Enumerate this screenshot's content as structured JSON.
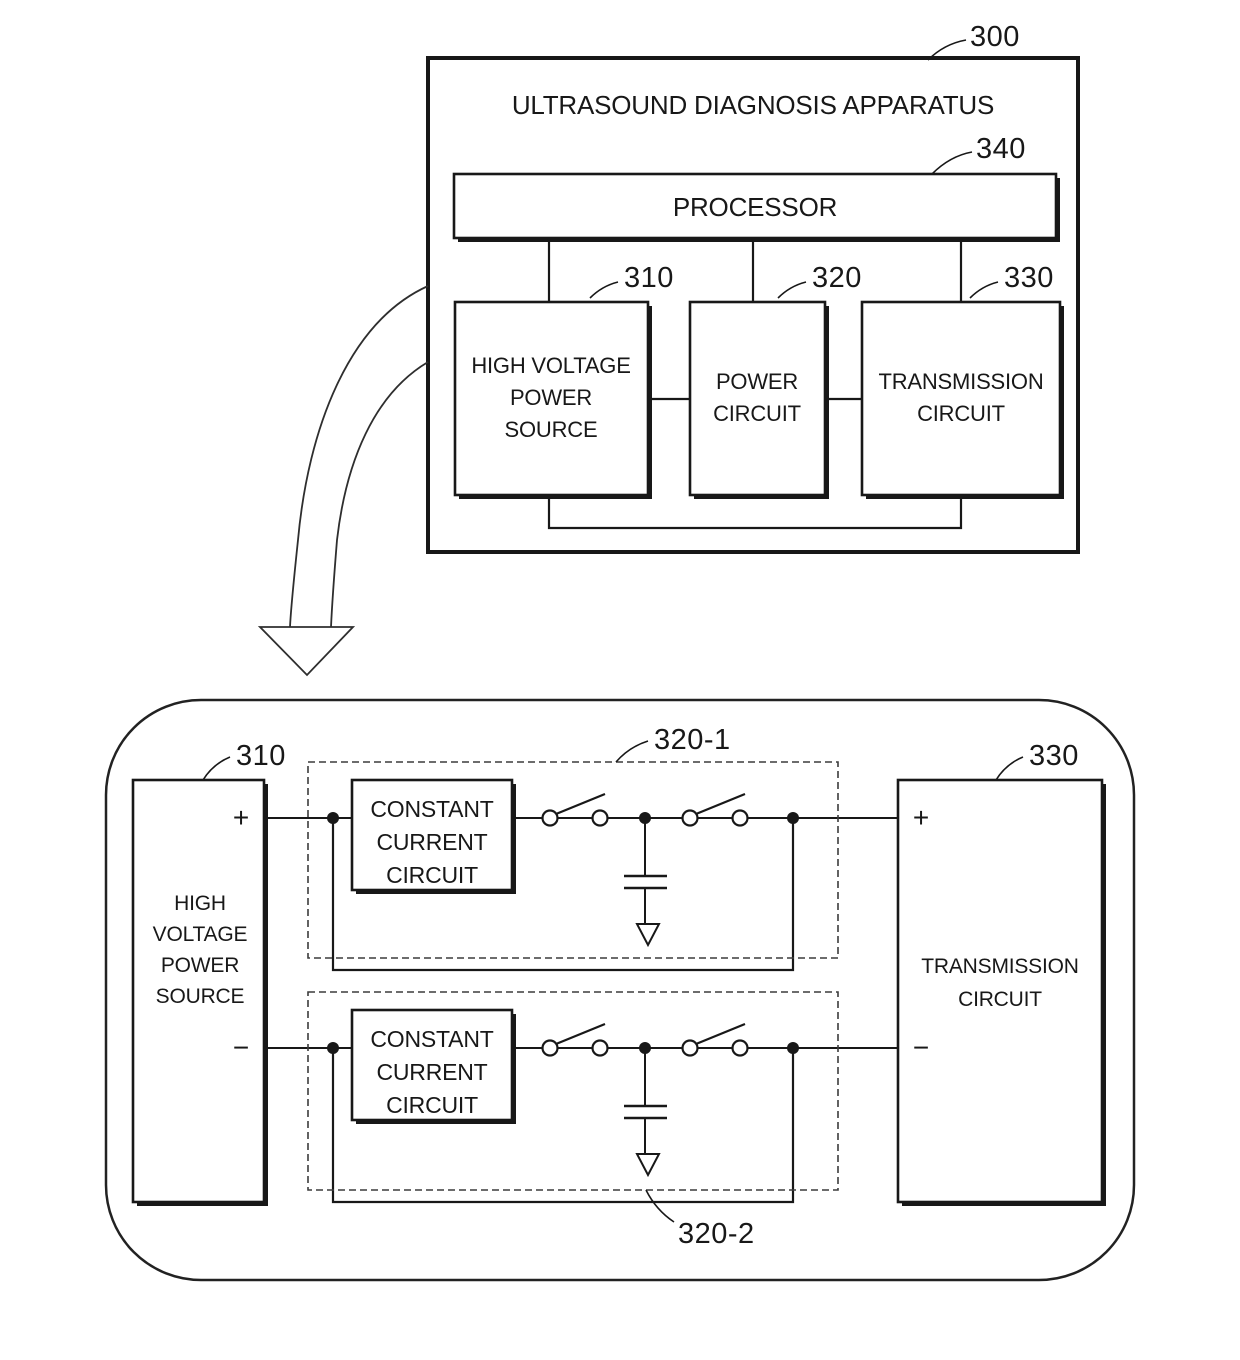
{
  "figure": {
    "overview": {
      "ref": "300",
      "title": "ULTRASOUND DIAGNOSIS APPARATUS",
      "processor": {
        "ref": "340",
        "label": "PROCESSOR"
      },
      "hvps": {
        "ref": "310",
        "lines": [
          "HIGH VOLTAGE",
          "POWER",
          "SOURCE"
        ]
      },
      "power": {
        "ref": "320",
        "lines": [
          "POWER",
          "CIRCUIT"
        ]
      },
      "trans": {
        "ref": "330",
        "lines": [
          "TRANSMISSION",
          "CIRCUIT"
        ]
      }
    },
    "detail": {
      "hvps": {
        "ref": "310",
        "lines": [
          "HIGH",
          "VOLTAGE",
          "POWER",
          "SOURCE"
        ],
        "plus": "+",
        "minus": "−"
      },
      "branch1": {
        "ref": "320-1",
        "ccc_lines": [
          "CONSTANT",
          "CURRENT",
          "CIRCUIT"
        ]
      },
      "branch2": {
        "ref": "320-2",
        "ccc_lines": [
          "CONSTANT",
          "CURRENT",
          "CIRCUIT"
        ]
      },
      "trans": {
        "ref": "330",
        "lines": [
          "TRANSMISSION",
          "CIRCUIT"
        ],
        "plus": "+",
        "minus": "−"
      }
    }
  }
}
